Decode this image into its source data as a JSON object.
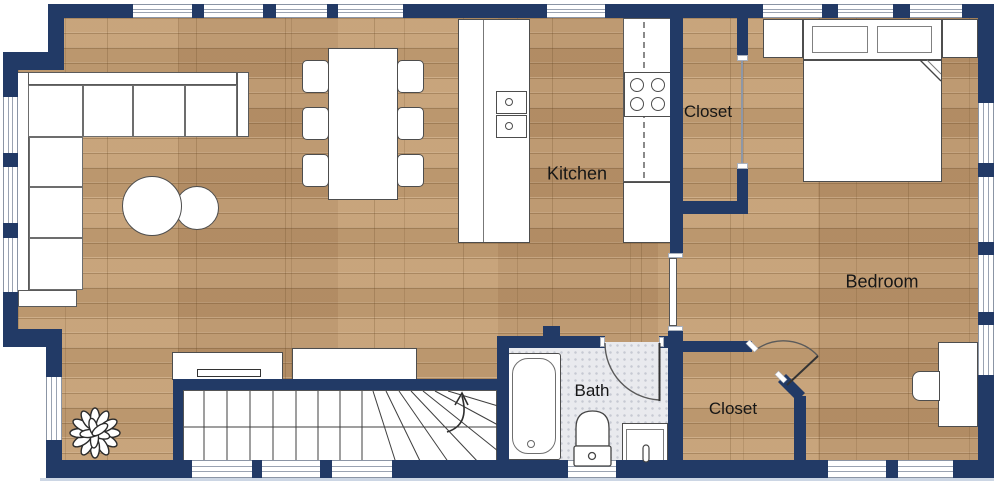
{
  "rooms": {
    "kitchen": {
      "label": "Kitchen"
    },
    "closet_top": {
      "label": "Closet"
    },
    "bedroom": {
      "label": "Bedroom"
    },
    "bath": {
      "label": "Bath"
    },
    "closet_bottom": {
      "label": "Closet"
    }
  },
  "colors": {
    "wall_navy": "#223a66",
    "floor_wood": "#c29a6d",
    "bath_tile": "#e9eaee",
    "furniture_outline": "#4d4d4d",
    "window_frame": "#8b95a5"
  },
  "symbols": {
    "stairs_direction": "up",
    "doors": [
      "bath-swing-door",
      "bedroom-closet-corner-door",
      "kitchen-sliding-door",
      "closet-open-doorway"
    ]
  }
}
